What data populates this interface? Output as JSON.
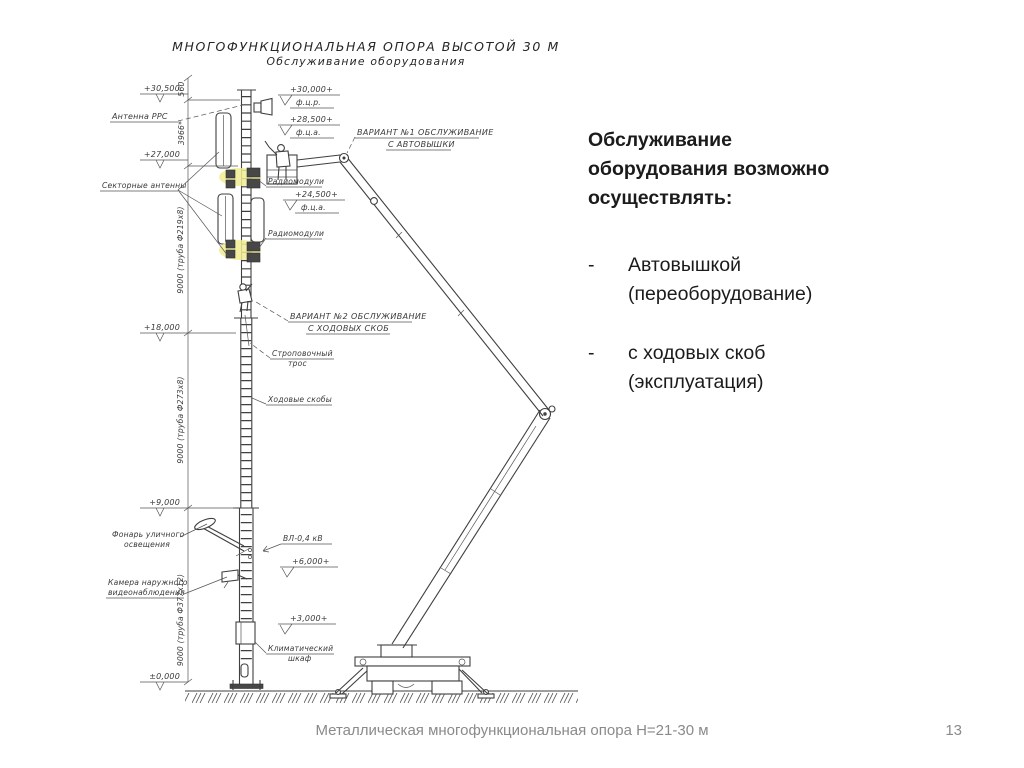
{
  "drawing": {
    "title": "МНОГОФУНКЦИОНАЛЬНАЯ ОПОРА ВЫСОТОЙ 30 М",
    "subtitle": "Обслуживание оборудования",
    "dims": {
      "d560": "560",
      "d3966": "3966*",
      "d9000a": "9000 (труба Ф219х8)",
      "d9000b": "9000 (труба Ф273х8)",
      "d9000c": "9000 (труба Ф377х12)"
    },
    "elev_left": {
      "e30500": "+30,500",
      "e27000": "+27,000",
      "e18000": "+18,000",
      "e9000": "+9,000",
      "e0": "±0,000"
    },
    "elev_right": {
      "e30000": "+30,000+",
      "e30000_note": "ф.ц.р.",
      "e28500": "+28,500+",
      "e28500_note": "ф.ц.а.",
      "e24500": "+24,500+",
      "e24500_note": "ф.ц.а.",
      "e6000": "+6,000+",
      "e3000": "+3,000+"
    },
    "labels": {
      "antenna_rrs": "Антенна РРС",
      "sector_antennas": "Секторные антенны",
      "radio_modules_1": "Радиомодули",
      "radio_modules_2": "Радиомодули",
      "variant1_line1": "ВАРИАНТ №1 ОБСЛУЖИВАНИЕ",
      "variant1_line2": "С АВТОВЫШКИ",
      "variant2_line1": "ВАРИАНТ №2 ОБСЛУЖИВАНИЕ",
      "variant2_line2": "С ХОДОВЫХ СКОБ",
      "sling_line1": "Строповочный",
      "sling_line2": "трос",
      "rungs": "Ходовые скобы",
      "lamp_line1": "Фонарь уличного",
      "lamp_line2": "освещения",
      "power_line": "ВЛ-0,4 кВ",
      "camera_line1": "Камера наружного",
      "camera_line2": "видеонаблюдения",
      "cabinet_line1": "Климатический",
      "cabinet_line2": "шкаф"
    }
  },
  "panel": {
    "heading": "Обслуживание оборудования возможно осуществлять:",
    "bullets": [
      {
        "marker": "-",
        "text": "Автовышкой (переоборудование)"
      },
      {
        "marker": "-",
        "text": "с ходовых скоб (эксплуатация)"
      }
    ]
  },
  "footer": {
    "caption": "Металлическая многофункциональная опора Н=21-30 м",
    "page_number": "13"
  },
  "colors": {
    "line": "#3f3f3f",
    "muted_text": "#8a8a8a",
    "highlight": "#f1ec92"
  }
}
